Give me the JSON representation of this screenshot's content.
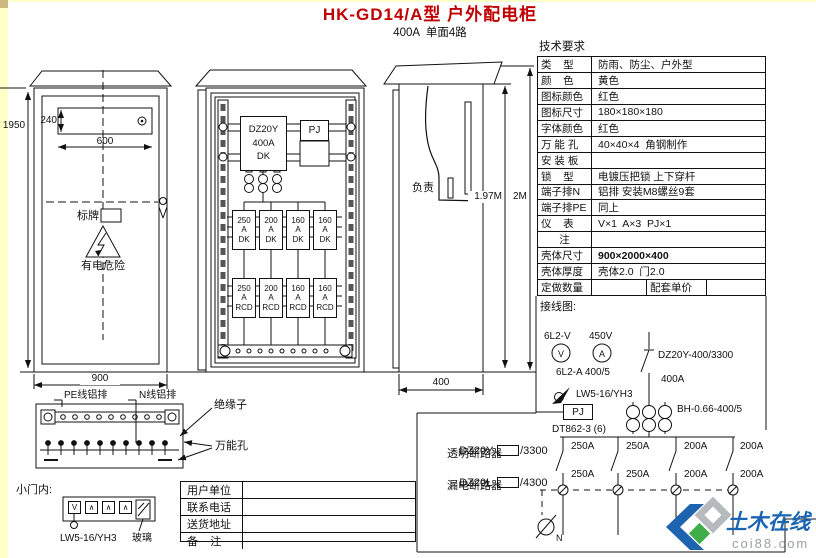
{
  "page": {
    "title": "HK-GD14/A型 户外配电柜",
    "subtitle": "400A  单面4路"
  },
  "tech": {
    "heading": "技术要求",
    "rows": [
      {
        "label": "类    型",
        "value": "防雨、防尘、户外型"
      },
      {
        "label": "颜    色",
        "value": "黄色"
      },
      {
        "label": "图标颜色",
        "value": "红色"
      },
      {
        "label": "图标尺寸",
        "value": "180×180×180"
      },
      {
        "label": "字体颜色",
        "value": "红色"
      },
      {
        "label": "万 能 孔",
        "value": "40×40×4  角钢制作"
      },
      {
        "label": "安 装 板",
        "value": ""
      },
      {
        "label": "锁    型",
        "value": "电镀压把锁 上下穿杆"
      },
      {
        "label": "端子排N",
        "value": "铝排 安装M8螺丝9套"
      },
      {
        "label": "端子排PE",
        "value": "同上"
      },
      {
        "label": "仪    表",
        "value": "V×1  A×3  PJ×1"
      },
      {
        "label": "注",
        "value": ""
      },
      {
        "label": "壳体尺寸",
        "value": "900×2000×400"
      },
      {
        "label": "壳体厚度",
        "value": "壳体2.0  门2.0"
      }
    ],
    "order_row": {
      "label": "定做数量",
      "value": "",
      "label2": "配套单价",
      "value2": ""
    }
  },
  "front_view": {
    "dim_height": "1950",
    "dim_window_height": "240",
    "dim_window_width": "600",
    "nameplate_label": "标牌",
    "danger_label": "有电危险",
    "dim_width": "900",
    "pe_bar_label": "PE线铝排",
    "n_bar_label": "N线铝排",
    "insulator_label": "绝缘子",
    "holes_label": "万能孔"
  },
  "inner_view": {
    "main_breaker": [
      "DZ20Y",
      "400A",
      "DK"
    ],
    "meter": "PJ",
    "unit": "A",
    "dk_type": "DK",
    "rcd_type": "RCD",
    "dk_amps": [
      "250",
      "200",
      "160",
      "160"
    ],
    "rcd_amps": [
      "250",
      "200",
      "160",
      "160"
    ]
  },
  "side_view": {
    "load_label": "负责",
    "dim_inner": "1.97M",
    "dim_outer": "2M",
    "dim_depth": "400"
  },
  "door_detail": {
    "heading": "小门内:",
    "meter_glyphs": [
      "V",
      "∧",
      "∧",
      "∧"
    ],
    "switch_label": "LW5-16/YH3",
    "glass_label": "玻璃"
  },
  "notes": {
    "line1_prefix": "DZ20Y-",
    "line1_suffix": "/3300",
    "line2": "透明断路器",
    "line3_prefix": "DZ20L-",
    "line3_suffix": "/4300",
    "line4": "漏电断路器"
  },
  "contact": {
    "rows": [
      {
        "label": "用户单位",
        "value": ""
      },
      {
        "label": "联系电话",
        "value": ""
      },
      {
        "label": "送货地址",
        "value": ""
      },
      {
        "label": "备    注",
        "value": ""
      }
    ]
  },
  "schematic": {
    "heading": "接线图:",
    "voltmeter_model": "6L2-V",
    "voltage": "450V",
    "voltmeter_glyph": "V",
    "ammeter_glyph": "A",
    "ammeter_model": "6L2-A 400/5",
    "selector_model": "LW5-16/YH3",
    "meter_box": "PJ",
    "energy_meter_model": "DT862-3 (6)",
    "main_breaker_model": "DZ20Y-400/3300",
    "main_rating": "400A",
    "ct_model": "BH-0.66-400/5",
    "branches_top": [
      "250A",
      "250A",
      "200A",
      "200A"
    ],
    "branches_bottom": [
      "250A",
      "250A",
      "200A",
      "200A"
    ],
    "neutral_label": "N"
  },
  "watermark": {
    "name": "土木在线",
    "site": "coi88.com"
  }
}
